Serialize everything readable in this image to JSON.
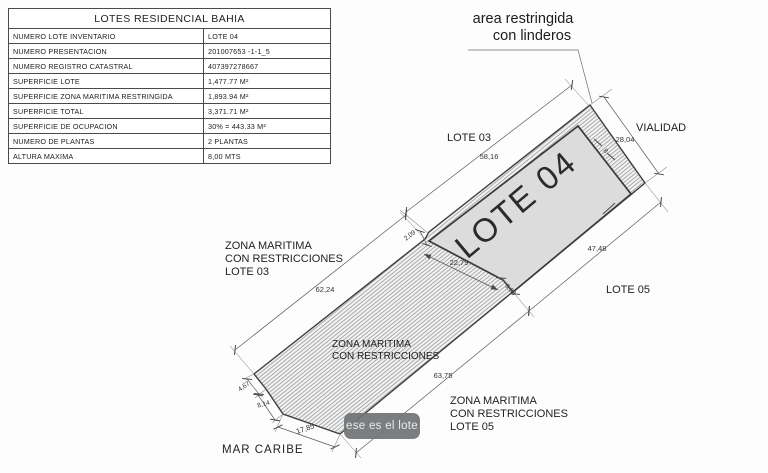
{
  "table": {
    "title": "LOTES RESIDENCIAL BAHIA",
    "rows": [
      {
        "label": "NUMERO LOTE INVENTARIO",
        "value": "LOTE 04"
      },
      {
        "label": "NUMERO PRESENTACION",
        "value": "201007653 -1-1_5"
      },
      {
        "label": "NUMERO REGISTRO CATASTRAL",
        "value": "407397278667"
      },
      {
        "label": "SUPERFICIE LOTE",
        "value": "1,477.77 M²"
      },
      {
        "label": "SUPERFICIE ZONA MARITIMA RESTRINGIDA",
        "value": "1,893.94 M²"
      },
      {
        "label": "SUPERFICIE TOTAL",
        "value": "3,371.71 M²"
      },
      {
        "label": "SUPERFICIE DE OCUPACION",
        "value": "30% = 443.33 M²"
      },
      {
        "label": "NUMERO DE PLANTAS",
        "value": "2 PLANTAS"
      },
      {
        "label": "ALTURA MAXIMA",
        "value": "8,00 MTS"
      }
    ]
  },
  "drawing": {
    "heading": {
      "line1": "area restringida",
      "line2": "con linderos"
    },
    "lot_name": "LOTE 04",
    "labels": {
      "lote03": "LOTE 03",
      "vialidad": "VIALIDAD",
      "lote05": "LOTE 05",
      "mar_caribe": "MAR CARIBE",
      "zona_left": {
        "line1": "ZONA MARITIMA",
        "line2": "CON RESTRICCIONES",
        "line3": "LOTE 03"
      },
      "zona_mid": {
        "line1": "ZONA MARITIMA",
        "line2": "CON RESTRICCIONES"
      },
      "zona_bottom": {
        "line1": "ZONA MARITIMA",
        "line2": "CON RESTRICCIONES",
        "line3": "LOTE 05"
      }
    },
    "dims": {
      "top_edge_upper": "58,16",
      "vialidad": "28,04",
      "band_width": "8",
      "lot_bottom": "47,48",
      "lot_cut": "22,79",
      "cut_step": "6,08",
      "kink_step": "2,09",
      "top_edge_lower": "62,24",
      "bottom_edge_lower": "63,75",
      "coast_a": "4,67",
      "coast_b": "8,14",
      "coast_c": "17,85"
    }
  },
  "tooltip": {
    "text": "ese es el lote"
  },
  "colors": {
    "lot_fill": "#dcdcdc",
    "hatch_line": "#8a8a8a",
    "hatch_bg": "#f3f3f3",
    "outline": "#3f3f3f",
    "tooltip_bg": "#717476",
    "tooltip_text": "#e9ece9"
  }
}
